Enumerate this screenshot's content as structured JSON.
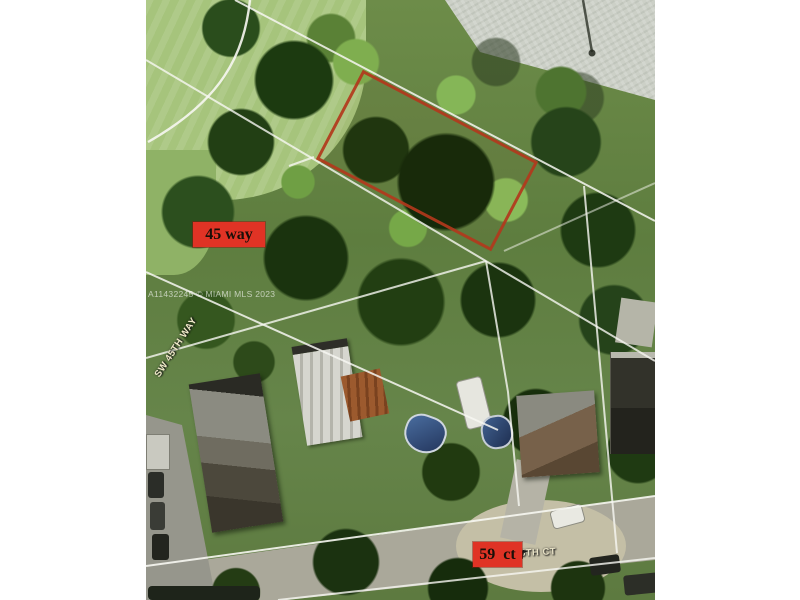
{
  "photo": {
    "watermark": "A11432245 © MIAMI MLS 2023",
    "streets": {
      "left_vertical": "SW 45TH WAY",
      "bottom": "5TH CT"
    },
    "tags": {
      "way": "45 way",
      "ct": "59  ct"
    },
    "colors": {
      "tag_background": "#e03325",
      "tag_text": "#190f08",
      "parcel_outline": "#b2381c",
      "parcel_lines": "#f7f7f2",
      "lawn": "#a6c47c",
      "road": "#ccd0c7",
      "canopy_dark": "#1c370f",
      "canopy_bright": "#85b657"
    }
  }
}
